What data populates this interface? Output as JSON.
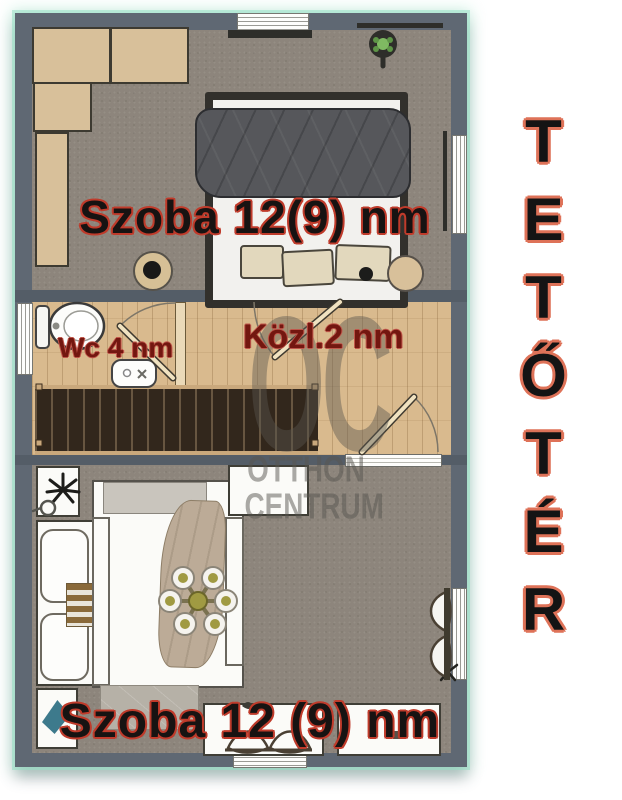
{
  "floorplan": {
    "side_title": "TETŐTÉR",
    "labels": {
      "top_room": "Szoba 12(9) nm",
      "wc": "Wc 4 nm",
      "hallway": "Közl.2 nm",
      "bottom_room": "Szoba 12 (9) nm"
    },
    "watermark": {
      "logo": "OC",
      "line1": "OTTHON",
      "line2": "CENTRUM"
    },
    "colors": {
      "wall": "#5f6873",
      "carpet": "#8d857c",
      "wood_floor": "#d9ba8e",
      "stairs": "#32271c",
      "furniture_beige": "#d8c09a",
      "room_label_fill": "#171312",
      "room_label_outline": "#bf3b2b",
      "small_label": "#731710",
      "side_title_fill": "#141414",
      "side_title_outline": "#de7258",
      "edge_glow": "#96e0c4"
    }
  }
}
